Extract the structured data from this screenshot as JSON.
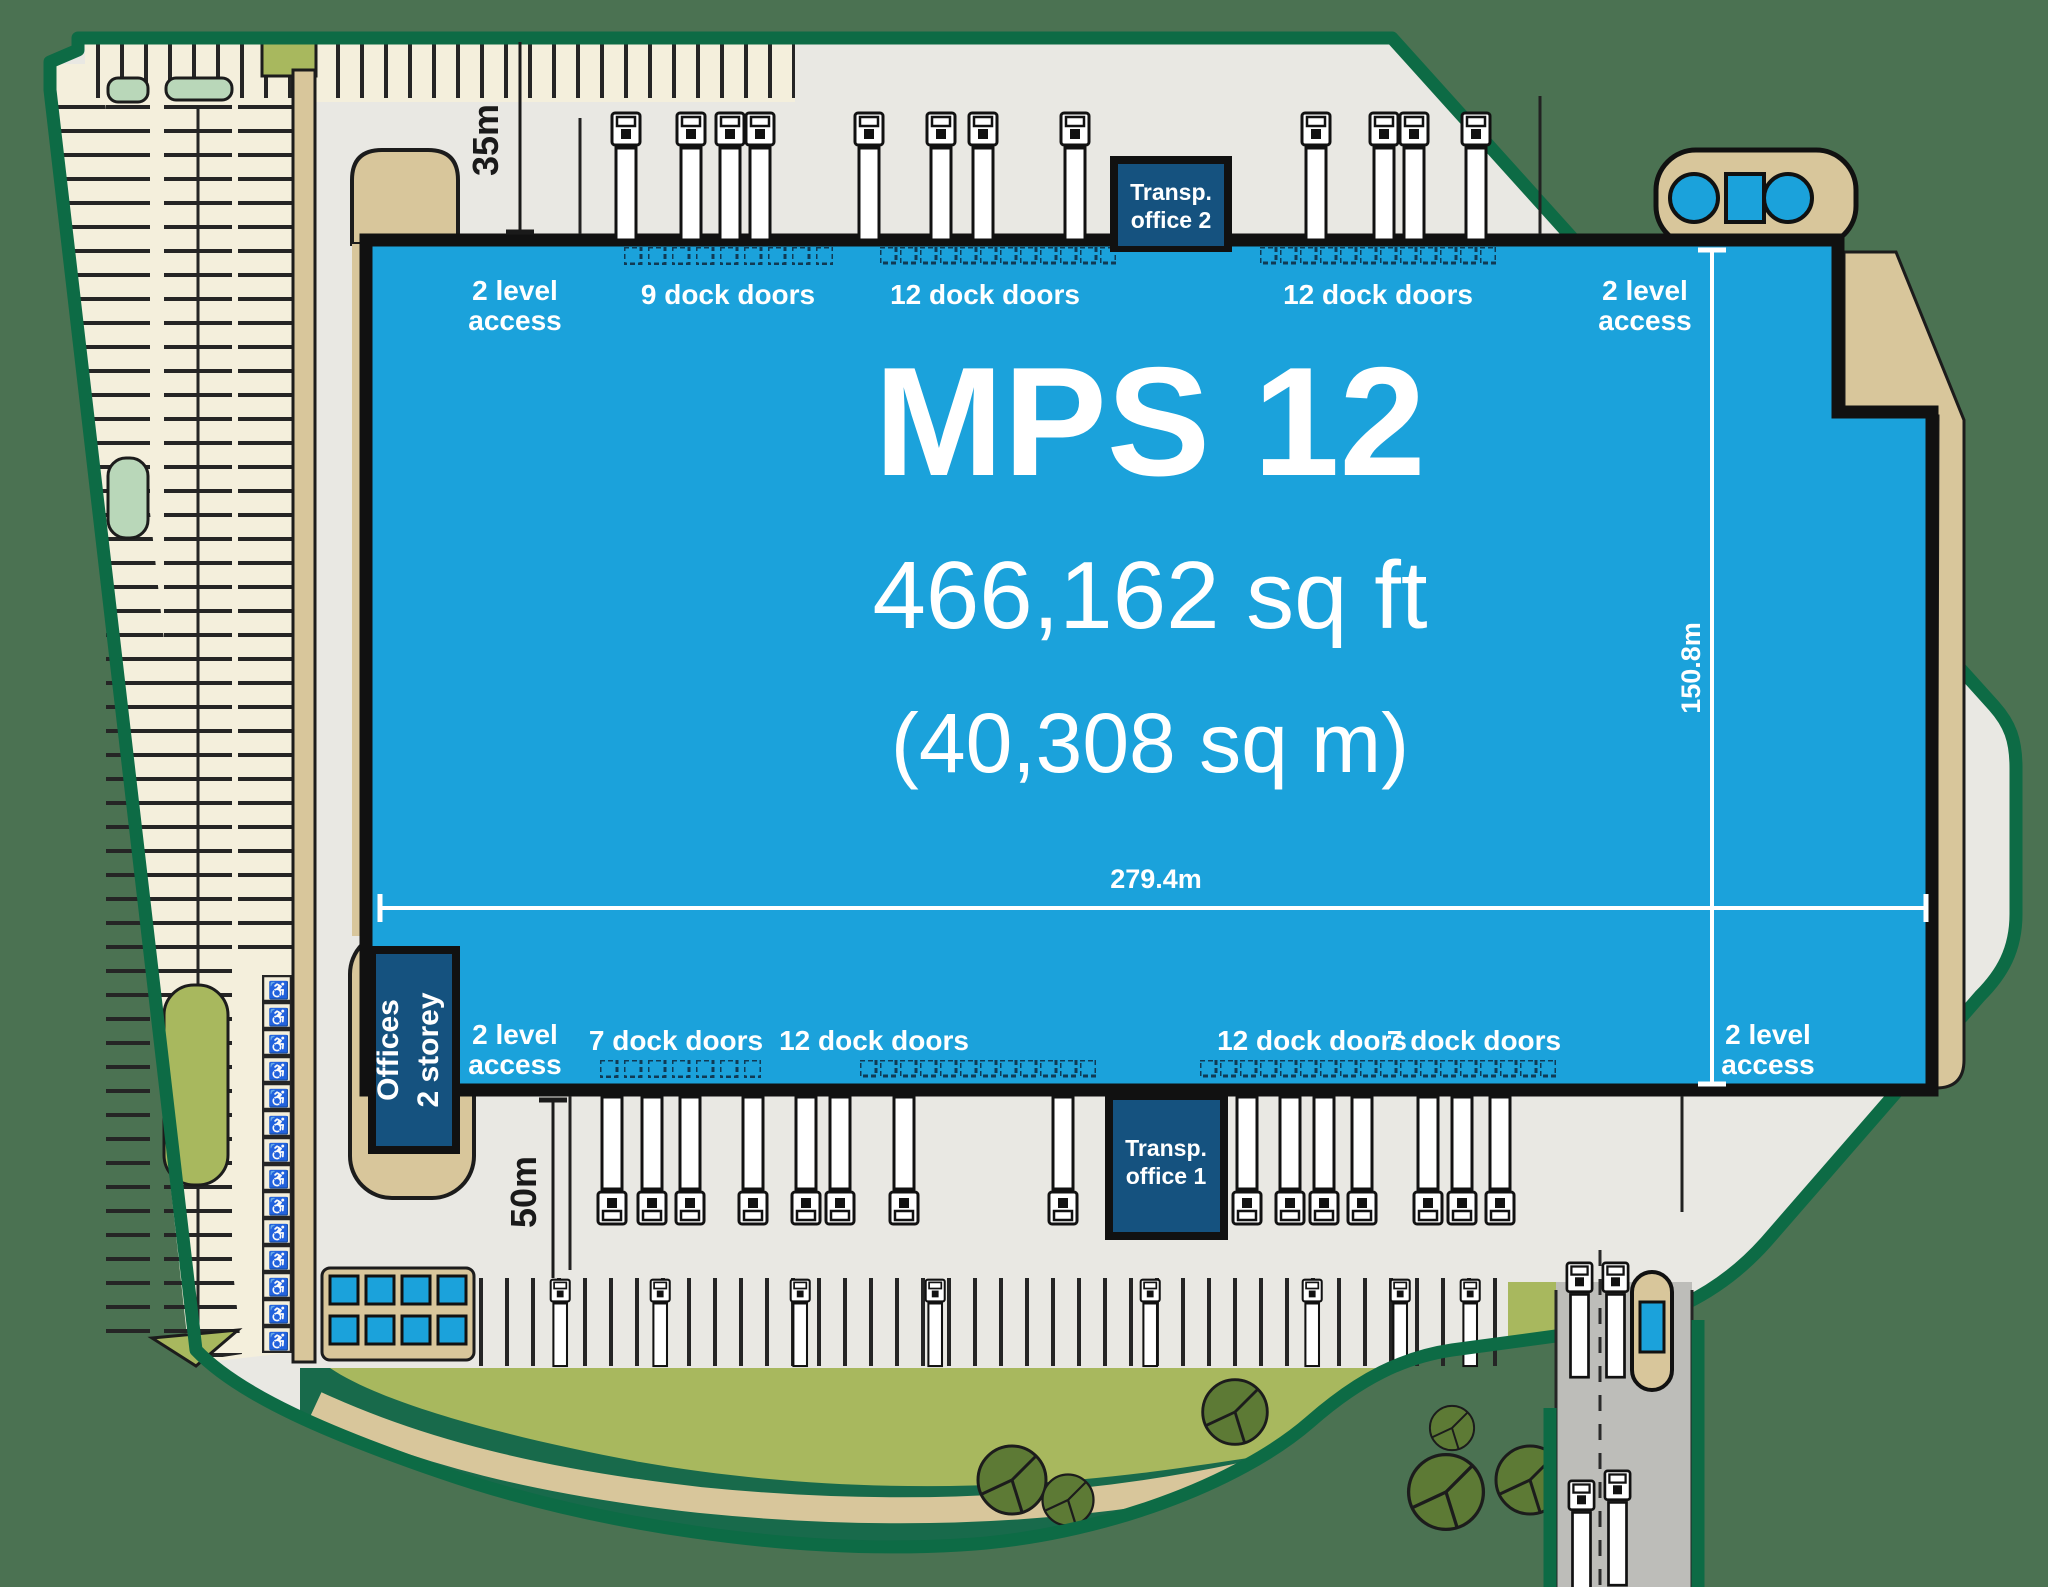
{
  "building": {
    "name": "MPS 12",
    "area_imperial": "466,162 sq ft",
    "area_metric": "(40,308 sq m)"
  },
  "dimensions": {
    "width": "279.4m",
    "depth": "150.8m",
    "north_yard": "35m",
    "south_yard": "50m"
  },
  "north_edge": {
    "access_left": {
      "line1": "2 level",
      "line2": "access"
    },
    "doors_1": "9 dock doors",
    "doors_2": "12 dock doors",
    "doors_3": "12 dock doors",
    "access_right": {
      "line1": "2 level",
      "line2": "access"
    }
  },
  "south_edge": {
    "access_left": {
      "line1": "2 level",
      "line2": "access"
    },
    "doors_1": "7 dock doors",
    "doors_2": "12 dock doors",
    "doors_3": "12 dock doors",
    "doors_4": "7 dock doors",
    "access_right": {
      "line1": "2 level",
      "line2": "access"
    }
  },
  "offices": {
    "line1": "Offices",
    "line2": "2 storey"
  },
  "transport_office_2": {
    "line1": "Transp.",
    "line2": "office 2"
  },
  "transport_office_1": {
    "line1": "Transp.",
    "line2": "office 1"
  },
  "colors": {
    "blue": "#1ba2db",
    "navy": "#15527f",
    "yard": "#e9e8e3",
    "cream": "#f4efdc",
    "tan": "#d8c69b",
    "olive": "#a8b85e",
    "mint": "#b9d7b9",
    "dgreen": "#186a4b",
    "boundary": "#0d6b45",
    "outer": "#4b7252",
    "road": "#bdbdb9",
    "ink": "#1a1a1a",
    "bush": "#5d7a35"
  }
}
